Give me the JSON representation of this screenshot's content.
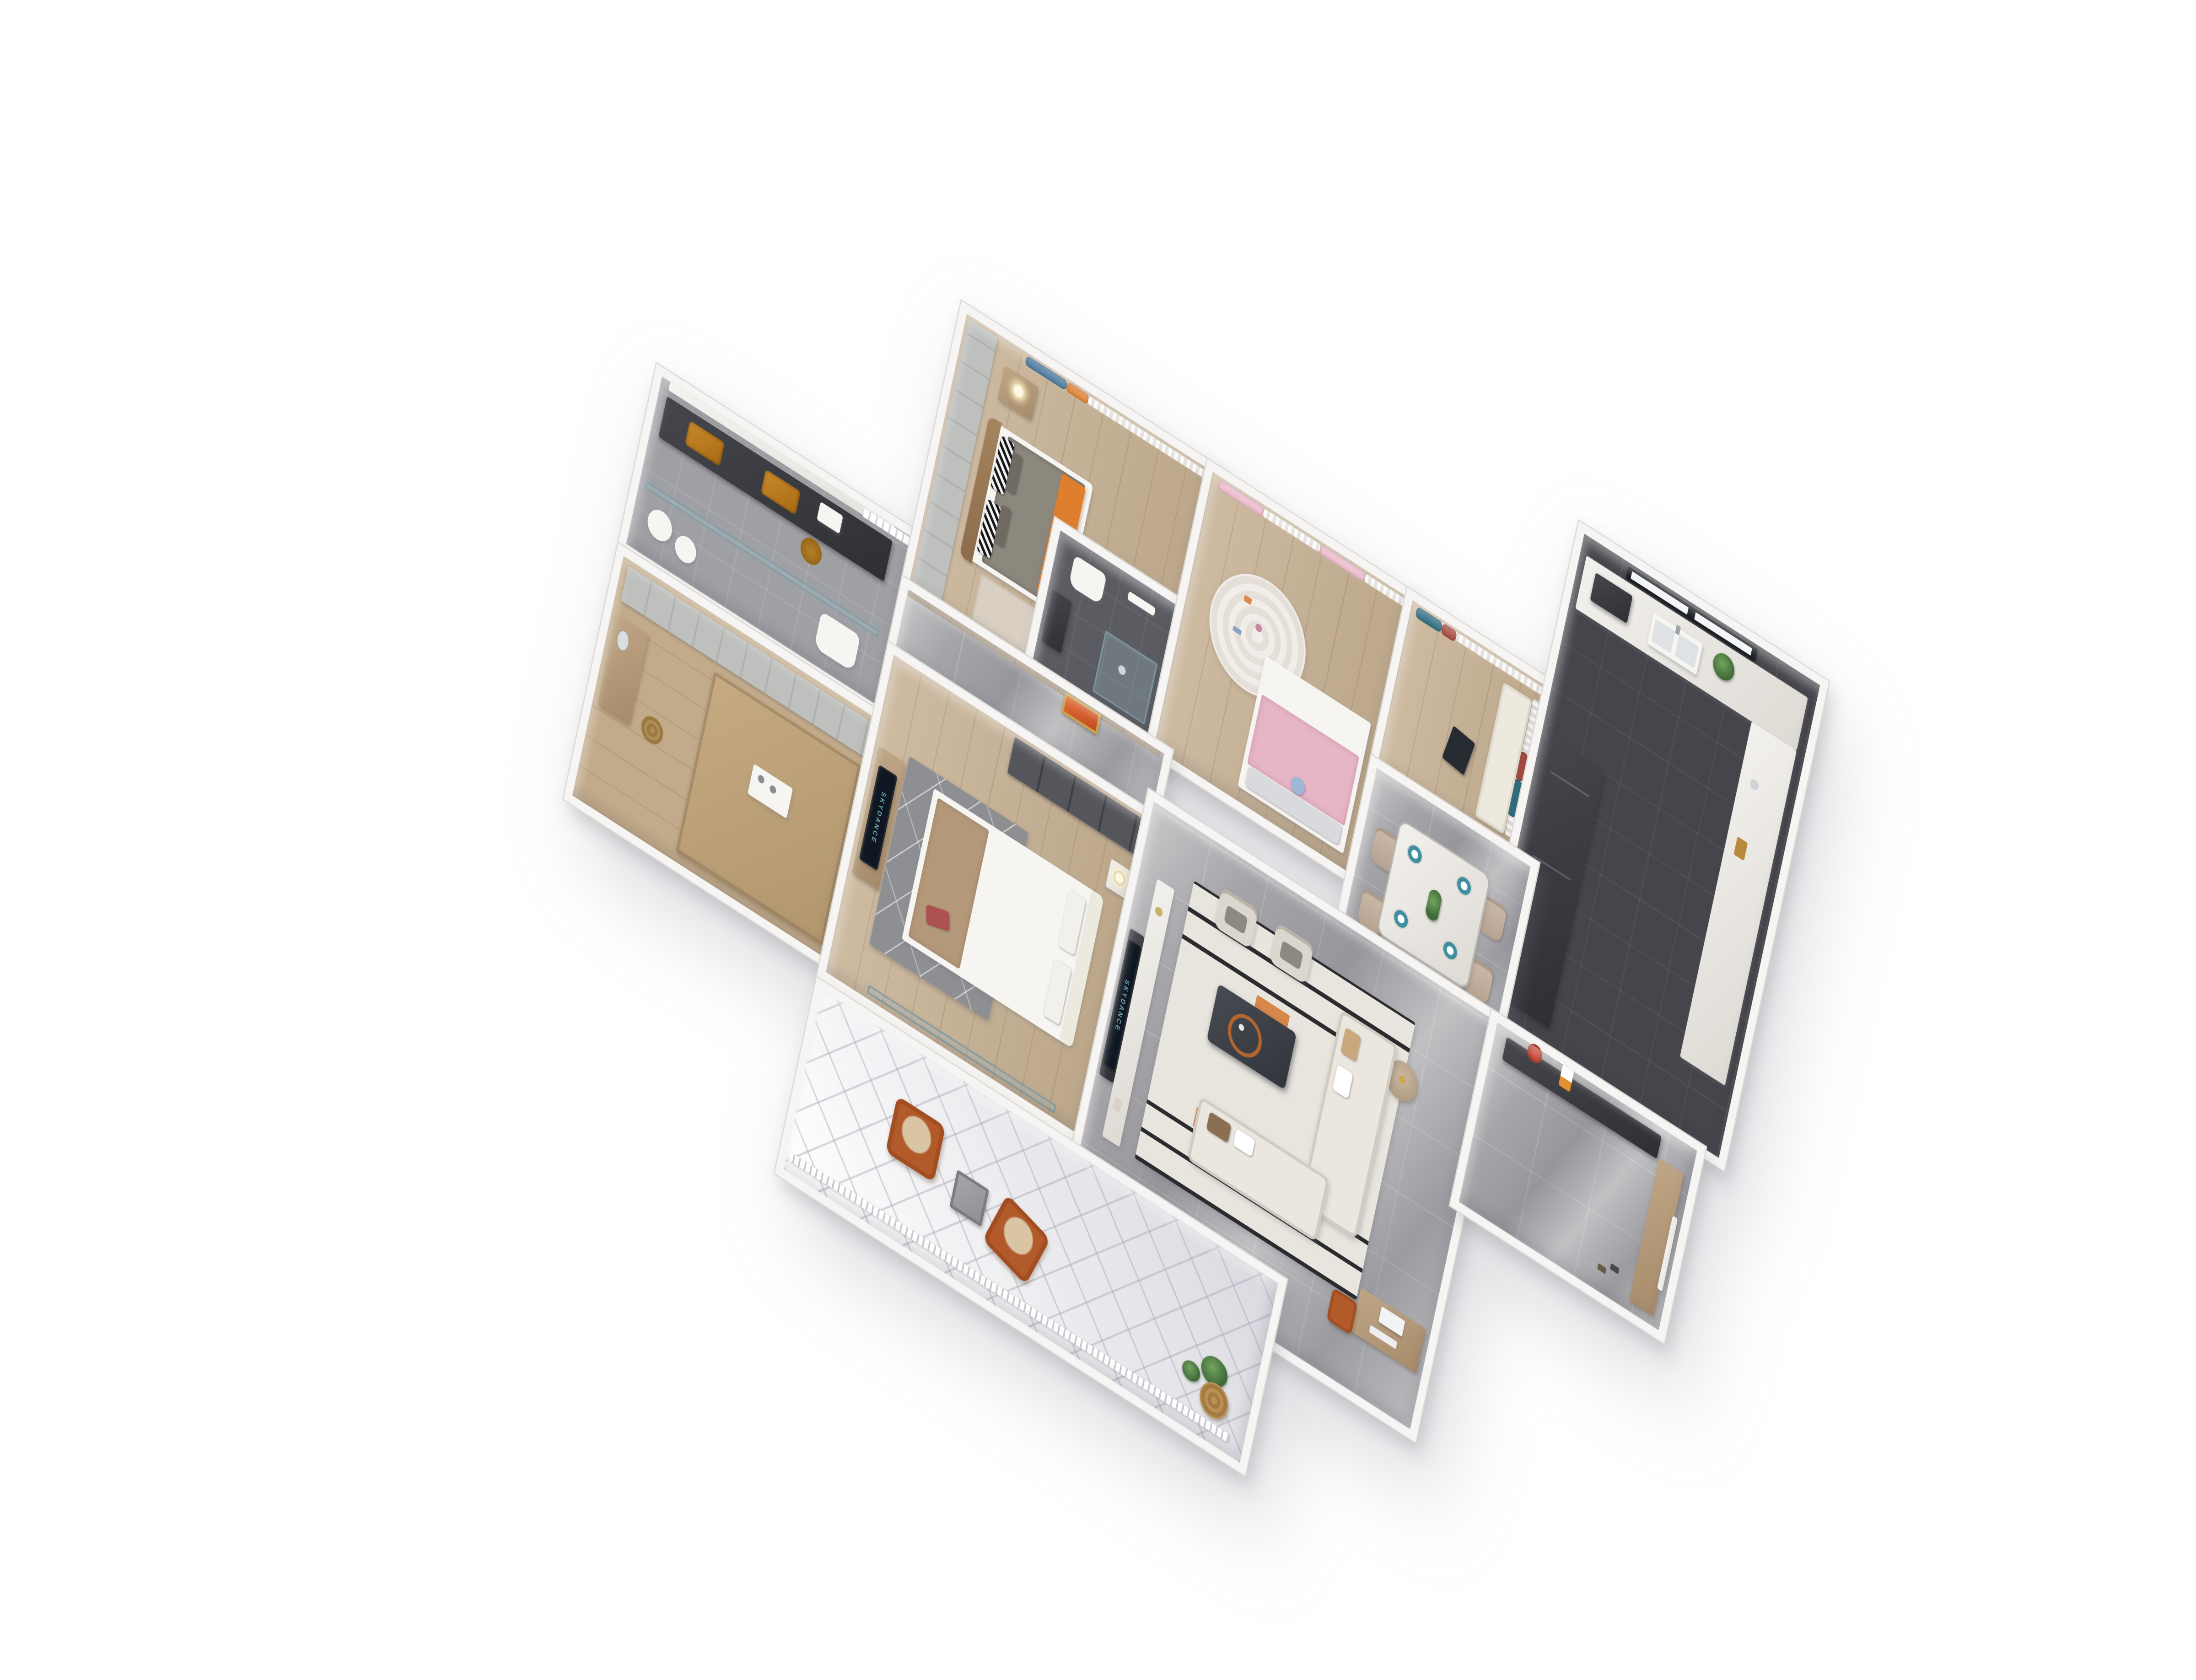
{
  "scene": {
    "type": "3d-floor-plan-render",
    "view": "axonometric top-down dollhouse view, rotated clockwise",
    "background": "#ffffff",
    "apartment": "four-bedroom apartment with living-dining area, kitchen and balcony"
  },
  "tv": {
    "brand_text": "SKYDANCE"
  },
  "palette": {
    "wall": "#f6f5f3",
    "wall-edge": "#dcdad5",
    "marble-floor": "#a6a6aa",
    "wood-floor": "#c7b295",
    "wood-dark": "#c2ab8a",
    "dark-floor": "#45454b",
    "ensuite-floor": "#5b5c62",
    "diamond-floor": "#e9e9ed",
    "orange": "#df7f2e",
    "blue-curtain": "#48779c",
    "teal-curtain": "#2f6e80",
    "red-curtain": "#a84a42",
    "pink-curtain": "#ecb9c9",
    "pink-duvet": "#e6b6c6",
    "rust": "#b25a2a",
    "sofa-cream": "#ebe7df",
    "gray-duvet": "#8d887e",
    "cabinet-dark": "#3f4046",
    "wood-furniture": "#b09272",
    "counter-marble": "#efede9",
    "tv-screen": "#0e1722",
    "tv-label": "#7fc7cf",
    "plant-green": "#4e7d46",
    "rug-stripe": "#2b2b2f",
    "chair-beige": "#c6b5a4"
  },
  "rooms": [
    {
      "id": "master-bathroom",
      "name": "Master bathroom",
      "floor": "gray tile",
      "furniture": [
        "dark double vanity counter",
        "two amber stone basins",
        "mirror",
        "towel trays",
        "slatted window",
        "glass partition",
        "toilet",
        "laundry baskets",
        "tall amber vessel"
      ]
    },
    {
      "id": "tatami-room",
      "name": "Tatami study / multi-function room",
      "floor": "wood",
      "furniture": [
        "built-in wardrobe",
        "vanity desk with mirror",
        "rattan stool",
        "tatami platform",
        "tea tray with cups"
      ]
    },
    {
      "id": "master-bedroom",
      "name": "Master bedroom",
      "floor": "wood",
      "furniture": [
        "paneled wardrobe wall",
        "double bed with gray duvet and orange throw",
        "brown curved headboard",
        "zigzag pattern pillows",
        "nightstand with table lamp",
        "blue and orange curtains with white sheers",
        "bedside rug"
      ]
    },
    {
      "id": "master-ensuite",
      "name": "Ensuite shower room",
      "floor": "dark tile",
      "furniture": [
        "glass shower cube",
        "toilet",
        "small dark vanity",
        "towel rail"
      ]
    },
    {
      "id": "kids-bedroom",
      "name": "Kids bedroom",
      "floor": "wood",
      "furniture": [
        "pink and white curtains with tassels",
        "round braided rug with toys",
        "bed with pink duvet and white sheets",
        "silver pillows",
        "plush toy"
      ]
    },
    {
      "id": "window-nook",
      "name": "Bay-window study nook",
      "floor": "wood",
      "furniture": [
        "teal and red curtains",
        "white sheer curtain",
        "window bench cushion",
        "dark leaning picture frame"
      ]
    },
    {
      "id": "kitchen",
      "name": "Kitchen",
      "floor": "dark tile",
      "furniture": [
        "black framed window",
        "L-shaped white marble counter",
        "double sink with faucet",
        "cooktop",
        "green plant",
        "tall dark cabinets and fridge"
      ]
    },
    {
      "id": "dining-room",
      "name": "Dining room",
      "floor": "gray marble",
      "furniture": [
        "marble dining table",
        "four teal place settings",
        "greenery centerpiece",
        "four beige upholstered chairs"
      ]
    },
    {
      "id": "corridor",
      "name": "Corridor",
      "floor": "gray marble",
      "furniture": [
        "wood panel wall",
        "gold framed orange artwork niche"
      ]
    },
    {
      "id": "bedroom-2",
      "name": "Second bedroom",
      "floor": "wood",
      "furniture": [
        "white bed with tan throw",
        "red accent pillow",
        "white tufted headboard",
        "gray geometric rug",
        "wood dresser with TV",
        "dark glass wardrobe",
        "marble nightstand with lamp",
        "balcony window"
      ]
    },
    {
      "id": "living-room",
      "name": "Living room",
      "floor": "gray marble",
      "furniture": [
        "wall mounted TV",
        "dark TV backing panel",
        "long white marble media console",
        "striped rug with orange accents",
        "L-shaped cream sectional sofa with pillows",
        "dark coffee table with rust tray",
        "two cream accent chairs",
        "round side table",
        "work desk with monitor and keyboard",
        "rust desk chair"
      ]
    },
    {
      "id": "entry-hall",
      "name": "Entry hall",
      "floor": "gray marble",
      "furniture": [
        "dark console with red flower vase",
        "white and orange decor stand",
        "wood shoe cabinet",
        "shoes",
        "entry door"
      ]
    },
    {
      "id": "balcony",
      "name": "Balcony",
      "floor": "white diamond tile",
      "furniture": [
        "two rust leather armchairs with beige cushions",
        "square side table",
        "rattan basket planter",
        "green plants",
        "white railing"
      ]
    }
  ]
}
